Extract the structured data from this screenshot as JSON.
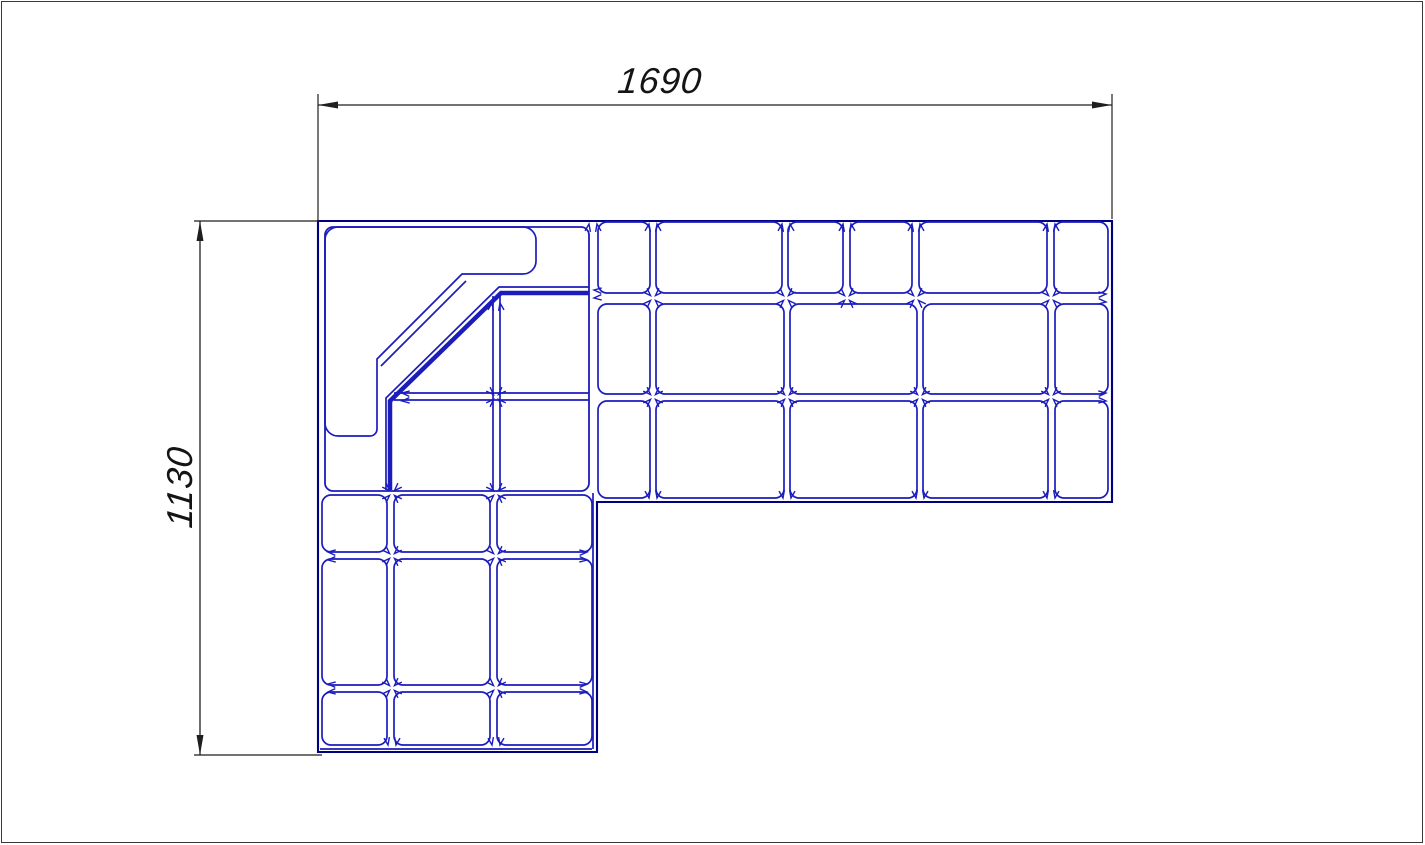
{
  "canvas": {
    "width": 1425,
    "height": 845,
    "background": "#ffffff",
    "border_color": "#3a3a3a"
  },
  "colors": {
    "line_blue": "#1c1cbc",
    "line_blue_dark": "#000082",
    "dimension_black": "#1f1f1f",
    "label_black": "#141414"
  },
  "dimension_annotations": {
    "width": {
      "label": "1690",
      "line": [
        318,
        105,
        1112,
        105
      ],
      "arrows": [
        {
          "x": 318,
          "y": 105,
          "a": 180
        },
        {
          "x": 1112,
          "y": 105,
          "a": 0
        }
      ],
      "ext": [
        [
          318,
          94,
          318,
          220
        ],
        [
          1112,
          94,
          1112,
          219
        ]
      ]
    },
    "height": {
      "label": "1130",
      "line": [
        200,
        221,
        200,
        755
      ],
      "arrows": [
        {
          "x": 200,
          "y": 221,
          "a": 270
        },
        {
          "x": 200,
          "y": 755,
          "a": 90
        }
      ],
      "ext": [
        [
          194,
          221,
          320,
          221
        ],
        [
          194,
          755,
          322,
          755
        ]
      ]
    }
  },
  "drawing": {
    "outer_path": "M318,221 H1112 V502 H597 V752 H318 Z",
    "corner_module_box": {
      "x": 325,
      "y": 227,
      "w": 264,
      "h": 264,
      "r": 8
    },
    "backrest_path": "M338,227 H523 A13,13 0 0 1 536,240 V261 A13,13 0 0 1 523,274 H462 L377,359 V429 A7,7 0 0 1 370,436 H338 A13,13 0 0 1 325,423 V240 A13,13 0 0 1 338,227 Z",
    "cushions": [
      [
        598,
        222,
        52,
        71
      ],
      [
        656,
        222,
        126,
        71
      ],
      [
        788,
        222,
        55,
        71
      ],
      [
        850,
        222,
        62,
        71
      ],
      [
        919,
        222,
        128,
        71
      ],
      [
        1054,
        222,
        54,
        71
      ],
      [
        598,
        304,
        52,
        90
      ],
      [
        656,
        304,
        128,
        90
      ],
      [
        790,
        304,
        127,
        90
      ],
      [
        923,
        304,
        125,
        90
      ],
      [
        1055,
        304,
        53,
        90
      ],
      [
        598,
        401,
        52,
        97
      ],
      [
        656,
        401,
        128,
        97
      ],
      [
        790,
        401,
        127,
        97
      ],
      [
        923,
        401,
        125,
        97
      ],
      [
        1055,
        401,
        53,
        97
      ],
      [
        322,
        495,
        65,
        57
      ],
      [
        394,
        495,
        96,
        57
      ],
      [
        497,
        495,
        95,
        57
      ],
      [
        322,
        559,
        65,
        126
      ],
      [
        394,
        559,
        96,
        126
      ],
      [
        497,
        559,
        95,
        126
      ],
      [
        322,
        692,
        65,
        53
      ],
      [
        394,
        692,
        96,
        53
      ],
      [
        497,
        692,
        95,
        53
      ]
    ],
    "lines": [
      [
        493,
        296,
        493,
        490
      ],
      [
        500,
        296,
        500,
        490
      ],
      [
        394,
        393,
        589,
        393
      ],
      [
        394,
        400,
        589,
        400
      ],
      [
        466,
        281,
        381,
        366
      ],
      [
        593,
        493,
        593,
        749
      ],
      [
        320,
        749,
        592,
        749
      ]
    ],
    "polylines": [
      {
        "points": [
          [
            589,
            287
          ],
          [
            499,
            287
          ],
          [
            386,
            398
          ],
          [
            386,
            490
          ]
        ],
        "width": 1.7
      },
      {
        "points": [
          [
            589,
            293
          ],
          [
            501,
            293
          ],
          [
            390,
            401
          ],
          [
            390,
            490
          ]
        ],
        "width": 4.5
      }
    ],
    "junctions": [
      {
        "x": 593,
        "y": 222,
        "t": "t_up"
      },
      {
        "x": 653,
        "y": 222,
        "t": "t_up"
      },
      {
        "x": 786,
        "y": 222,
        "t": "t_up"
      },
      {
        "x": 847,
        "y": 222,
        "t": "t_up"
      },
      {
        "x": 916,
        "y": 222,
        "t": "t_up"
      },
      {
        "x": 1051,
        "y": 222,
        "t": "t_up"
      },
      {
        "x": 496,
        "y": 301,
        "t": "t_up"
      },
      {
        "x": 653,
        "y": 298,
        "t": "cross"
      },
      {
        "x": 786,
        "y": 298,
        "t": "cross"
      },
      {
        "x": 847,
        "y": 298,
        "t": "cross"
      },
      {
        "x": 916,
        "y": 298,
        "t": "cross"
      },
      {
        "x": 1051,
        "y": 298,
        "t": "cross"
      },
      {
        "x": 496,
        "y": 397,
        "t": "cross"
      },
      {
        "x": 653,
        "y": 397,
        "t": "cross"
      },
      {
        "x": 787,
        "y": 397,
        "t": "cross"
      },
      {
        "x": 920,
        "y": 397,
        "t": "cross"
      },
      {
        "x": 1051,
        "y": 397,
        "t": "cross"
      },
      {
        "x": 392,
        "y": 493,
        "t": "cross"
      },
      {
        "x": 496,
        "y": 493,
        "t": "cross"
      },
      {
        "x": 392,
        "y": 556,
        "t": "cross"
      },
      {
        "x": 496,
        "y": 556,
        "t": "cross"
      },
      {
        "x": 392,
        "y": 688,
        "t": "cross"
      },
      {
        "x": 496,
        "y": 688,
        "t": "cross"
      },
      {
        "x": 653,
        "y": 500,
        "t": "t_down"
      },
      {
        "x": 787,
        "y": 500,
        "t": "t_down"
      },
      {
        "x": 920,
        "y": 500,
        "t": "t_down"
      },
      {
        "x": 1051,
        "y": 500,
        "t": "t_down"
      },
      {
        "x": 392,
        "y": 747,
        "t": "t_down"
      },
      {
        "x": 496,
        "y": 747,
        "t": "t_down"
      },
      {
        "x": 400,
        "y": 397,
        "t": "t_left"
      },
      {
        "x": 326,
        "y": 556,
        "t": "t_left"
      },
      {
        "x": 326,
        "y": 688,
        "t": "t_left"
      },
      {
        "x": 592,
        "y": 294,
        "t": "t_left"
      },
      {
        "x": 1108,
        "y": 298,
        "t": "t_right"
      },
      {
        "x": 1108,
        "y": 397,
        "t": "t_right"
      },
      {
        "x": 589,
        "y": 556,
        "t": "t_right"
      },
      {
        "x": 589,
        "y": 688,
        "t": "t_right"
      }
    ]
  }
}
